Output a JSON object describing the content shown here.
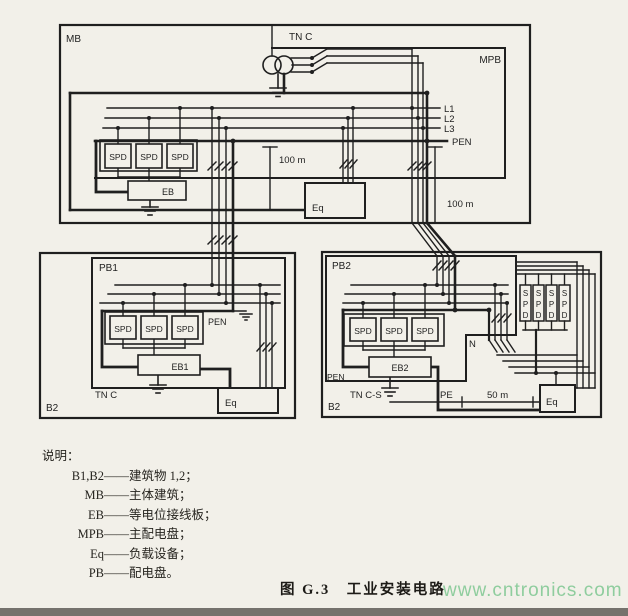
{
  "diagram": {
    "top": {
      "mb": "MB",
      "tn_c": "TN C",
      "mpb": "MPB",
      "l1": "L1",
      "l2": "L2",
      "l3": "L3",
      "pen": "PEN",
      "spd": "SPD",
      "eb": "EB",
      "eq": "Eq",
      "dist_left": "100 m",
      "dist_right": "100 m"
    },
    "bottom_left": {
      "pb1": "PB1",
      "b2": "B2",
      "tn_c": "TN C",
      "pen": "PEN",
      "spd": "SPD",
      "eb1": "EB1",
      "eq": "Eq"
    },
    "bottom_right": {
      "pb2": "PB2",
      "b2": "B2",
      "tn_cs": "TN C-S",
      "pen": "PEN",
      "n": "N",
      "pe": "PE",
      "dist": "50 m",
      "spd": "SPD",
      "eb2": "EB2",
      "eq": "Eq",
      "spd_s": "S",
      "spd_p": "P",
      "spd_d": "D"
    }
  },
  "legend": {
    "title": "说明：",
    "dash": "——",
    "items": [
      {
        "key": "B1,B2",
        "desc": "建筑物 1,2；"
      },
      {
        "key": "MB",
        "desc": "主体建筑；"
      },
      {
        "key": "EB",
        "desc": "等电位接线板；"
      },
      {
        "key": "MPB",
        "desc": "主配电盘；"
      },
      {
        "key": "Eq",
        "desc": "负载设备；"
      },
      {
        "key": "PB",
        "desc": "配电盘。"
      }
    ]
  },
  "caption": "图 G.3　工业安装电路",
  "watermark": "www.cntronics.com",
  "colors": {
    "ink": "#1f1f1f",
    "paper": "#f2f0e9",
    "watermark_green": "#8fcd9e"
  }
}
